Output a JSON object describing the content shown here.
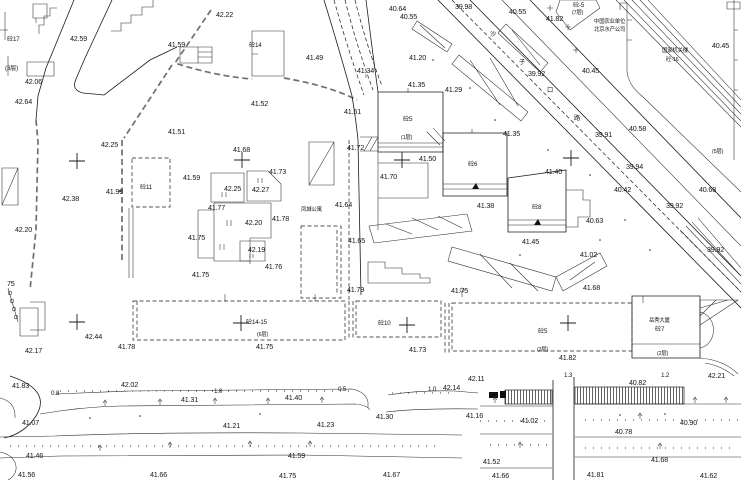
{
  "map": {
    "colors": {
      "paper": "#ffffff",
      "ink": "#1b1b1b",
      "fence": "#6f6f6f"
    },
    "elevations": [
      "42.22",
      "42.59",
      "42.06",
      "42.64",
      "41.59",
      "41.51",
      "42.25",
      "40.64",
      "40.55",
      "39.98",
      "40.55",
      "41.82",
      "40.45",
      "39.92",
      "40.45",
      "41.49",
      "41.52",
      "41.34",
      "41.20",
      "41.35",
      "41.29",
      "41.51",
      "41.35",
      "40.58",
      "39.91",
      "41.72",
      "41.50",
      "41.40",
      "39.94",
      "41.68",
      "41.73",
      "41.59",
      "42.25",
      "42.27",
      "41.93",
      "42.38",
      "41.70",
      "40.42",
      "40.68",
      "41.64",
      "41.38",
      "39.92",
      "41.77",
      "40.63",
      "42.20",
      "41.78",
      "42.20",
      "41.75",
      "41.65",
      "41.45",
      "42.19",
      "39.92",
      "41.02",
      "41.76",
      "41.75",
      "75",
      "41.79",
      "41.75",
      "41.68",
      "42.44",
      "42.17",
      "41.78",
      "41.75",
      "41.73",
      "41.82",
      "42.11",
      "42.21",
      "40.82",
      "41.83",
      "42.02",
      "42.14",
      "41.31",
      "41.40",
      "41.30",
      "41.16",
      "41.07",
      "41.21",
      "41.23",
      "41.02",
      "40.90",
      "40.78",
      "41.46",
      "41.59",
      "41.52",
      "41.68",
      "41.56",
      "41.66",
      "41.75",
      "41.67",
      "41.66",
      "41.81",
      "41.62"
    ],
    "dimensions": [
      "0.8",
      "1.0",
      "0.5",
      "1.0",
      "1.3",
      "1.2"
    ],
    "names": [
      "砼17",
      "(3层)",
      "砼14",
      "砼-5",
      "(7层)",
      "中国农业单位",
      "北京水产公司",
      "国家机关楼",
      "砼-16",
      "沙",
      "子",
      "口",
      "路",
      "砼11",
      "凤城公寓",
      "砼5",
      "(1层)",
      "砼6",
      "砼8",
      "(5层)",
      "砼14-15",
      "(6层)",
      "砼10",
      "砼5",
      "(3层)",
      "岳秀大厦",
      "砼7",
      "(2层)"
    ]
  }
}
